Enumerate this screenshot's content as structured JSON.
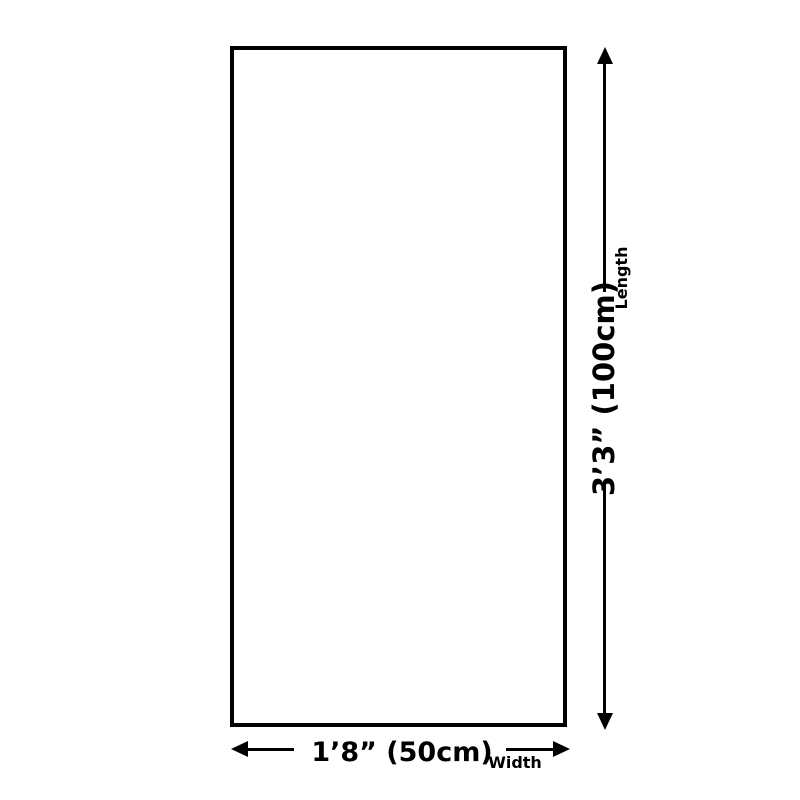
{
  "diagram": {
    "kind": "product-size-dimension-diagram",
    "colors": {
      "background": "#ffffff",
      "outline": "#000000",
      "text": "#000000"
    },
    "width_dimension": {
      "value": "1’8” (50cm)",
      "axis_label": "Width"
    },
    "length_dimension": {
      "value": "3’3” (100cm)",
      "axis_label": "Length"
    }
  }
}
